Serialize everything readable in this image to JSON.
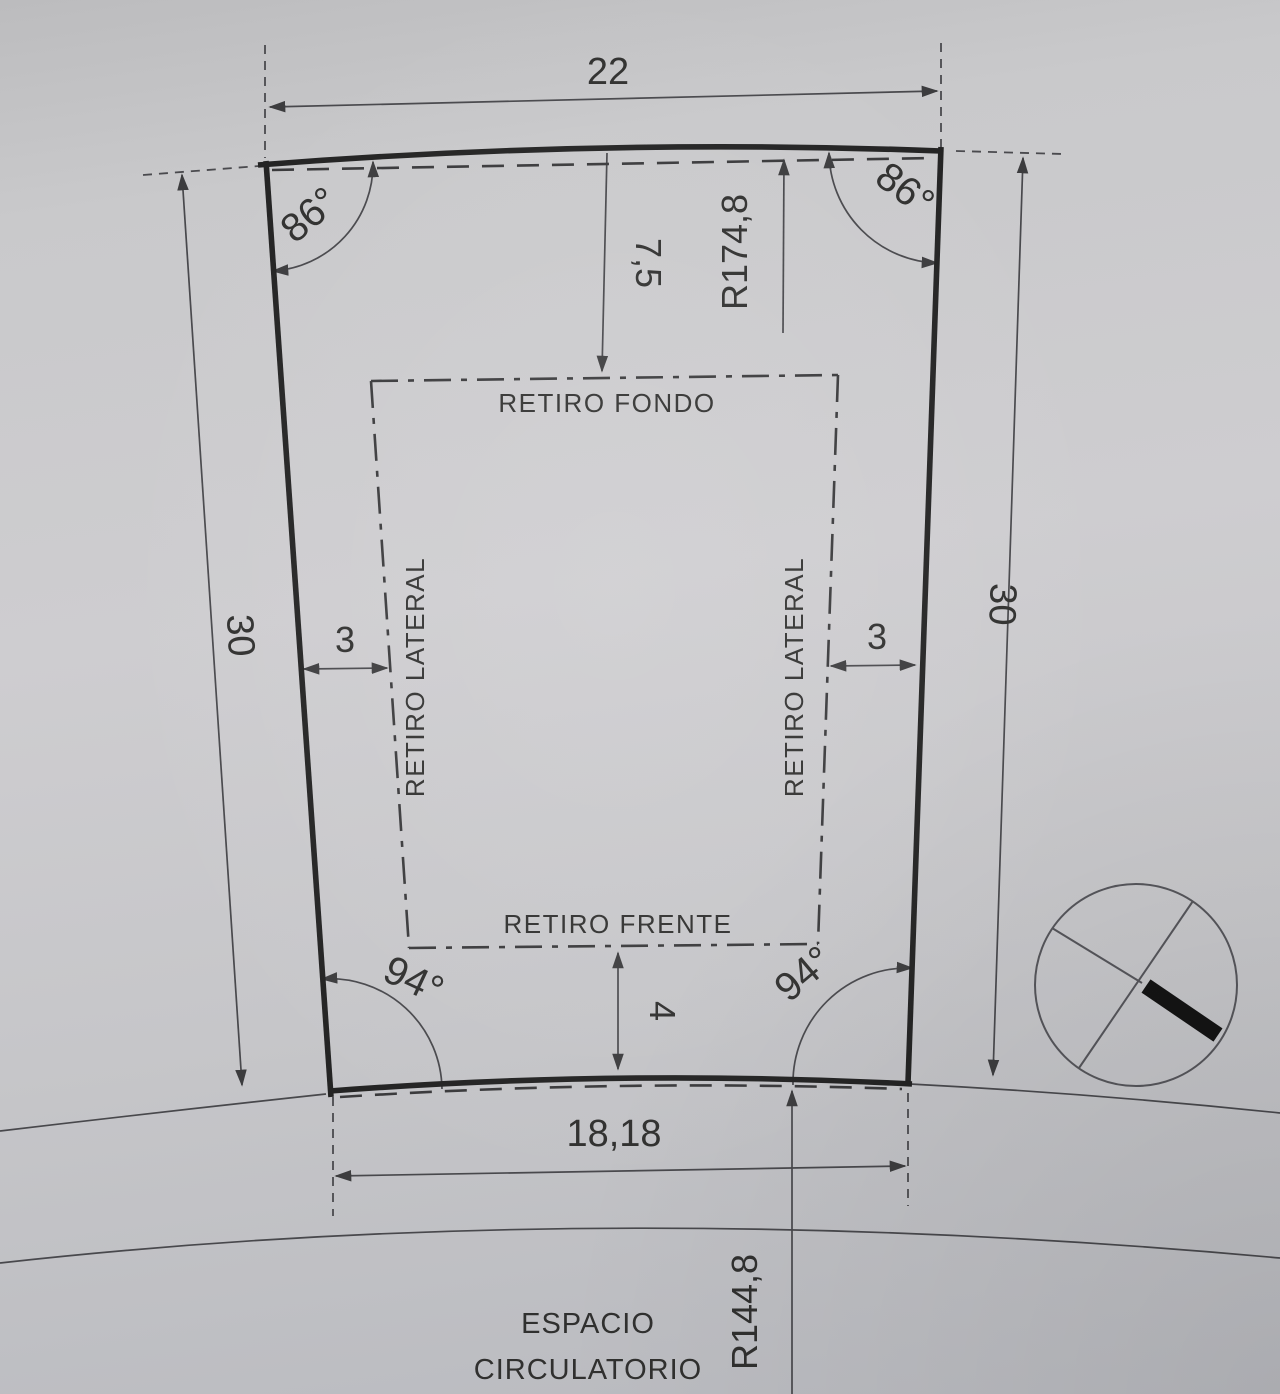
{
  "drawing": {
    "dims": {
      "top_width": "22",
      "depth_left": "30",
      "depth_right": "30",
      "front_width": "18,18",
      "back_setback": "7,5",
      "front_setback": "4",
      "side_setback_left": "3",
      "side_setback_right": "3",
      "radius_back": "R174,8",
      "radius_front": "R144,8"
    },
    "angles": {
      "top_left": "86°",
      "top_right": "86°",
      "bottom_left": "94°",
      "bottom_right": "94°"
    },
    "labels": {
      "retiro_fondo": "RETIRO FONDO",
      "retiro_frente": "RETIRO FRENTE",
      "retiro_lateral_left": "RETIRO LATERAL",
      "retiro_lateral_right": "RETIRO LATERAL",
      "road_line1": "ESPACIO",
      "road_line2": "CIRCULATORIO"
    },
    "colors": {
      "paper": "#c9c9cb",
      "ink": "#30302f",
      "boundary": "#232323"
    }
  }
}
